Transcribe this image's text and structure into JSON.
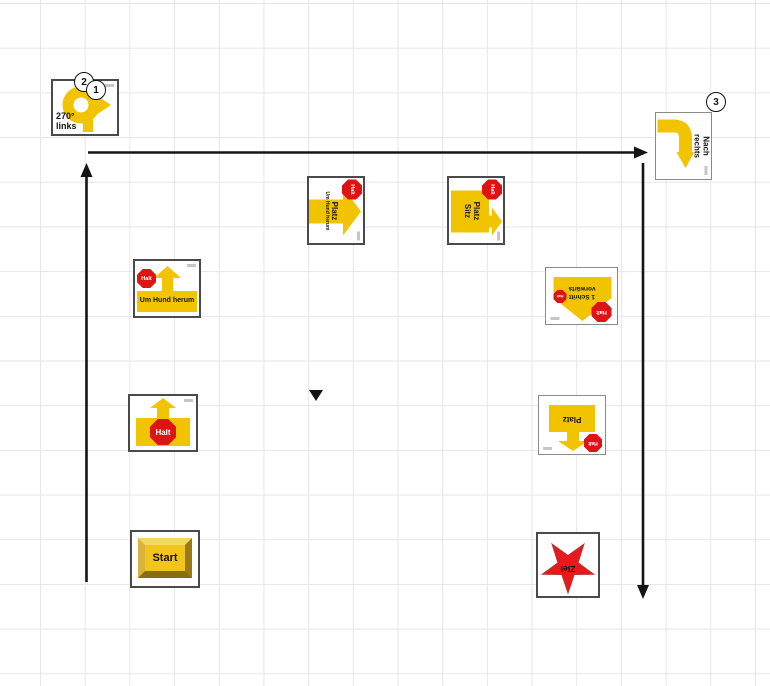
{
  "markers": {
    "m1": "1",
    "m2": "2",
    "m3": "3"
  },
  "signs": {
    "turn270": {
      "line1": "270°",
      "line2": "links"
    },
    "nachRechts": {
      "line1": "Nach",
      "line2": "rechts"
    },
    "platzUmHund": {
      "halt": "Halt",
      "title": "Platz",
      "subtitle": "Um Hund herum"
    },
    "platzSitz": {
      "halt": "Halt",
      "line1": "Platz",
      "line2": "Sitz"
    },
    "umHundHerum": {
      "halt": "Halt",
      "label": "Um Hund herum"
    },
    "schrittVorwaerts": {
      "halt": "Halt",
      "haltSmall": "Halt",
      "line1": "1 Schritt",
      "line2": "vorwärts"
    },
    "haltStop": {
      "halt": "Halt"
    },
    "platz": {
      "halt": "Halt",
      "label": "Platz"
    },
    "start": {
      "label": "Start"
    },
    "ziel": {
      "label": "Ziel"
    }
  },
  "colors": {
    "signYellow": "#F2C400",
    "haltRed": "#DE1414",
    "starRed": "#E8191C",
    "arrowBlack": "#151515",
    "gridGray": "#E6E6E6"
  }
}
